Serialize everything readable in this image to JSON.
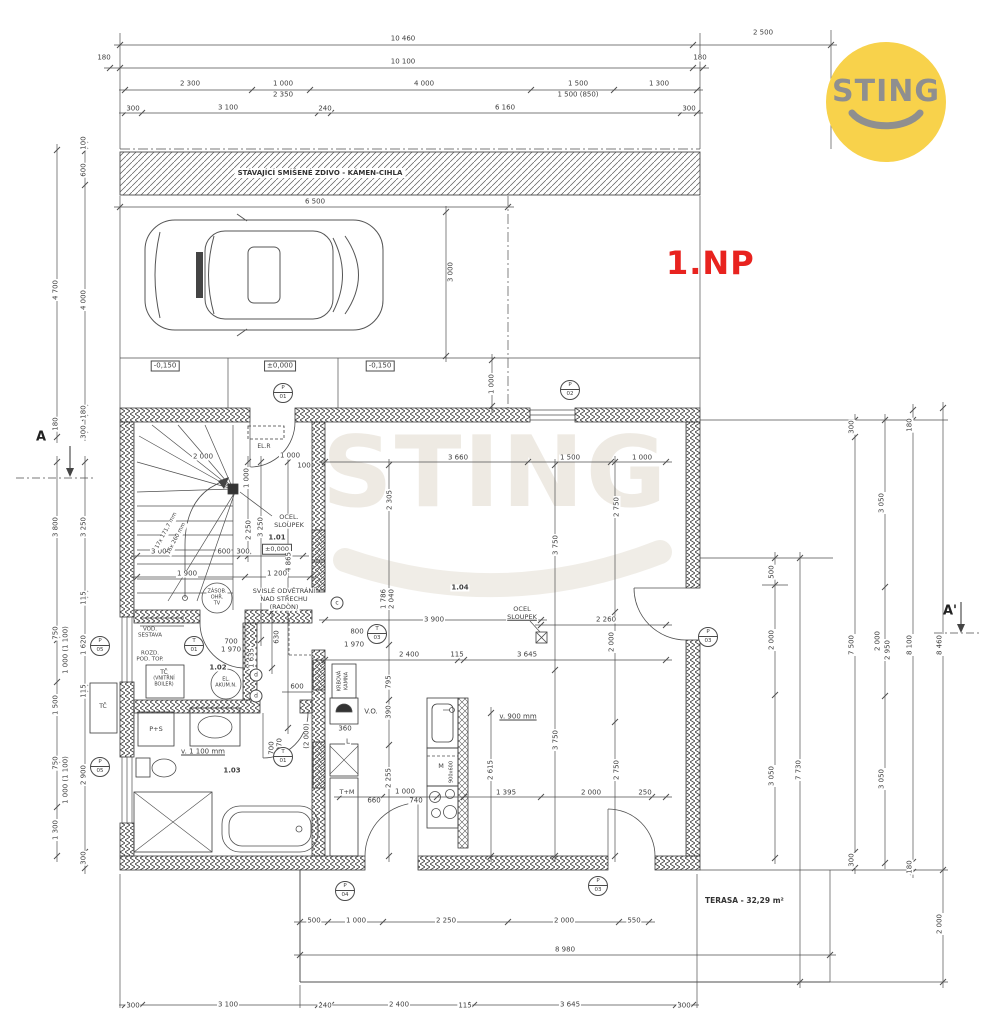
{
  "floor_label": "1.NP",
  "logo": {
    "text": "STING",
    "bg": "#F8D24B",
    "fg": "#8F8F8F"
  },
  "watermark": {
    "text": "STING"
  },
  "colors": {
    "line": "#4f4f4f",
    "wall": "#3f3f3f",
    "accent_red": "#e8231f",
    "logo_yellow": "#F8D24B"
  },
  "existing_wall": {
    "label": "STÁVAJÍCÍ SMÍŠENÉ ZDIVO - KÁMEN-CIHLA"
  },
  "terrace": {
    "label": "TERASA - 32,29 m²"
  },
  "sections": {
    "left": "A",
    "right": "A'"
  },
  "levels": [
    "-0,150",
    "±0,000",
    "-0,150"
  ],
  "stairs_note": [
    "17x 171,7 mm",
    "16x 260 mm"
  ],
  "annotations": [
    {
      "t": "10 460",
      "x": 403,
      "y": 39
    },
    {
      "t": "2 500",
      "x": 763,
      "y": 33
    },
    {
      "t": "180",
      "x": 104,
      "y": 58
    },
    {
      "t": "10 100",
      "x": 403,
      "y": 62
    },
    {
      "t": "180",
      "x": 700,
      "y": 58
    },
    {
      "t": "2 300",
      "x": 190,
      "y": 84
    },
    {
      "t": "1 000",
      "x": 283,
      "y": 84
    },
    {
      "t": "2 350",
      "x": 283,
      "y": 95
    },
    {
      "t": "4 000",
      "x": 424,
      "y": 84
    },
    {
      "t": "1 500",
      "x": 578,
      "y": 84
    },
    {
      "t": "1 500 (850)",
      "x": 578,
      "y": 95
    },
    {
      "t": "1 300",
      "x": 659,
      "y": 84
    },
    {
      "t": "300",
      "x": 133,
      "y": 109
    },
    {
      "t": "3 100",
      "x": 228,
      "y": 108
    },
    {
      "t": "240",
      "x": 325,
      "y": 109
    },
    {
      "t": "6 160",
      "x": 505,
      "y": 108
    },
    {
      "t": "300",
      "x": 689,
      "y": 109
    },
    {
      "t": "6 500",
      "x": 315,
      "y": 202
    },
    {
      "t": "3 000",
      "x": 451,
      "y": 272,
      "r": -90
    },
    {
      "t": "1 000",
      "x": 492,
      "y": 384,
      "r": -90
    },
    {
      "t": "4 700",
      "x": 56,
      "y": 290,
      "r": -90
    },
    {
      "t": "100",
      "x": 84,
      "y": 143,
      "r": -90
    },
    {
      "t": "600",
      "x": 84,
      "y": 170,
      "r": -90
    },
    {
      "t": "4 000",
      "x": 84,
      "y": 300,
      "r": -90
    },
    {
      "t": "180",
      "x": 56,
      "y": 424,
      "r": -90
    },
    {
      "t": "180",
      "x": 84,
      "y": 412,
      "r": -90
    },
    {
      "t": "300",
      "x": 84,
      "y": 432,
      "r": -90
    },
    {
      "t": "3 800",
      "x": 56,
      "y": 527,
      "r": -90
    },
    {
      "t": "3 250",
      "x": 84,
      "y": 527,
      "r": -90
    },
    {
      "t": "115",
      "x": 84,
      "y": 598,
      "r": -90
    },
    {
      "t": "750",
      "x": 56,
      "y": 633,
      "r": -90
    },
    {
      "t": "1 000 (1 100)",
      "x": 66,
      "y": 650,
      "r": -90
    },
    {
      "t": "1 620",
      "x": 84,
      "y": 645,
      "r": -90
    },
    {
      "t": "1 500",
      "x": 56,
      "y": 705,
      "r": -90
    },
    {
      "t": "115",
      "x": 84,
      "y": 691,
      "r": -90
    },
    {
      "t": "750",
      "x": 56,
      "y": 763,
      "r": -90
    },
    {
      "t": "1 000 (1 100)",
      "x": 66,
      "y": 780,
      "r": -90
    },
    {
      "t": "2 900",
      "x": 84,
      "y": 775,
      "r": -90
    },
    {
      "t": "1 300",
      "x": 56,
      "y": 830,
      "r": -90
    },
    {
      "t": "300",
      "x": 84,
      "y": 858,
      "r": -90
    },
    {
      "t": "2 000",
      "x": 203,
      "y": 457
    },
    {
      "t": "1 000",
      "x": 290,
      "y": 456
    },
    {
      "t": "100",
      "x": 304,
      "y": 466
    },
    {
      "t": "1 000",
      "x": 247,
      "y": 478,
      "r": -90
    },
    {
      "t": "EL.R",
      "x": 264,
      "y": 447,
      "s": 6
    },
    {
      "t": "OCEL.",
      "x": 289,
      "y": 517,
      "s": 6.5
    },
    {
      "t": "SLOUPEK",
      "x": 289,
      "y": 525,
      "s": 6.5
    },
    {
      "t": "1.01",
      "x": 277,
      "y": 538,
      "b": 1
    },
    {
      "t": "±0,000",
      "x": 277,
      "y": 549,
      "box": 1,
      "s": 6.5
    },
    {
      "t": "3 250",
      "x": 261,
      "y": 527,
      "r": -90
    },
    {
      "t": "2 250",
      "x": 249,
      "y": 530,
      "r": -90
    },
    {
      "t": "4 865",
      "x": 289,
      "y": 562,
      "r": -90
    },
    {
      "t": "3 000",
      "x": 161,
      "y": 552
    },
    {
      "t": "600",
      "x": 224,
      "y": 552
    },
    {
      "t": "300",
      "x": 243,
      "y": 552
    },
    {
      "t": "1 900",
      "x": 187,
      "y": 574
    },
    {
      "t": "1 200",
      "x": 277,
      "y": 574
    },
    {
      "t": "ZÁSOB.",
      "x": 217,
      "y": 592,
      "s": 5
    },
    {
      "t": "OHŘ.",
      "x": 217,
      "y": 598,
      "s": 5
    },
    {
      "t": "TV",
      "x": 217,
      "y": 604,
      "s": 5
    },
    {
      "t": "SVISLÉ ODVĚTRÁNÍ",
      "x": 284,
      "y": 591,
      "s": 6.5
    },
    {
      "t": "NAD STŘECHU",
      "x": 284,
      "y": 599,
      "s": 6.5
    },
    {
      "t": "(RADON)",
      "x": 284,
      "y": 607,
      "s": 6.5
    },
    {
      "t": "630",
      "x": 277,
      "y": 637,
      "r": -90
    },
    {
      "t": "1 635",
      "x": 252,
      "y": 658,
      "r": -90
    },
    {
      "t": "600",
      "x": 297,
      "y": 687
    },
    {
      "t": "VOD.",
      "x": 150,
      "y": 630,
      "s": 5.5
    },
    {
      "t": "SESTAVA",
      "x": 150,
      "y": 636,
      "s": 5.5
    },
    {
      "t": "ROZD.",
      "x": 150,
      "y": 654,
      "s": 5.5
    },
    {
      "t": "POD. TOP.",
      "x": 150,
      "y": 660,
      "s": 5.5
    },
    {
      "t": "700",
      "x": 231,
      "y": 642
    },
    {
      "t": "1 970",
      "x": 231,
      "y": 650
    },
    {
      "t": "1.02",
      "x": 218,
      "y": 668,
      "b": 1
    },
    {
      "t": "TČ",
      "x": 164,
      "y": 673,
      "s": 6
    },
    {
      "t": "(VNITŘNÍ",
      "x": 164,
      "y": 680,
      "s": 4.8
    },
    {
      "t": "BOILER)",
      "x": 164,
      "y": 686,
      "s": 4.8
    },
    {
      "t": "EL.",
      "x": 226,
      "y": 680,
      "s": 5
    },
    {
      "t": "AKUM.N.",
      "x": 226,
      "y": 686,
      "s": 5
    },
    {
      "t": "TČ",
      "x": 103,
      "y": 707,
      "s": 6
    },
    {
      "t": "P+S",
      "x": 156,
      "y": 729,
      "s": 6.5
    },
    {
      "t": "v. 1 100 mm",
      "x": 203,
      "y": 752,
      "u": 1
    },
    {
      "t": "1.03",
      "x": 232,
      "y": 771,
      "b": 1
    },
    {
      "t": "700",
      "x": 272,
      "y": 748,
      "r": -90
    },
    {
      "t": "1 970",
      "x": 280,
      "y": 748,
      "r": -90
    },
    {
      "t": "(2 000)",
      "x": 307,
      "y": 736,
      "r": -90
    },
    {
      "t": "KRBOVÁ",
      "x": 340,
      "y": 681,
      "r": -90,
      "s": 5
    },
    {
      "t": "KAMNA",
      "x": 347,
      "y": 681,
      "r": -90,
      "s": 5
    },
    {
      "t": "V.O.",
      "x": 371,
      "y": 712,
      "s": 7
    },
    {
      "t": "360",
      "x": 345,
      "y": 729
    },
    {
      "t": "L",
      "x": 348,
      "y": 742
    },
    {
      "t": "T+M",
      "x": 347,
      "y": 792,
      "s": 6.5
    },
    {
      "t": "795",
      "x": 389,
      "y": 682,
      "r": -90
    },
    {
      "t": "390",
      "x": 389,
      "y": 712,
      "r": -90
    },
    {
      "t": "2 255",
      "x": 389,
      "y": 778,
      "r": -90
    },
    {
      "t": "660",
      "x": 374,
      "y": 801
    },
    {
      "t": "1 000",
      "x": 405,
      "y": 792
    },
    {
      "t": "740",
      "x": 416,
      "y": 801
    },
    {
      "t": "M",
      "x": 441,
      "y": 766,
      "s": 6.5
    },
    {
      "t": "900x600",
      "x": 452,
      "y": 772,
      "r": -90,
      "s": 5
    },
    {
      "t": "2 615",
      "x": 491,
      "y": 770,
      "r": -90
    },
    {
      "t": "v. 900 mm",
      "x": 518,
      "y": 717,
      "u": 1
    },
    {
      "t": "3 660",
      "x": 458,
      "y": 458
    },
    {
      "t": "1 500",
      "x": 570,
      "y": 458
    },
    {
      "t": "1 000",
      "x": 642,
      "y": 458
    },
    {
      "t": "2 305",
      "x": 390,
      "y": 500,
      "r": -90
    },
    {
      "t": "3 750",
      "x": 556,
      "y": 545,
      "r": -90
    },
    {
      "t": "2 750",
      "x": 617,
      "y": 507,
      "r": -90
    },
    {
      "t": "1.04",
      "x": 460,
      "y": 588,
      "b": 1
    },
    {
      "t": "OCEL",
      "x": 522,
      "y": 609,
      "s": 6.5
    },
    {
      "t": "SLOUPEK",
      "x": 522,
      "y": 617,
      "s": 6.5,
      "u": 1
    },
    {
      "t": "1 786",
      "x": 384,
      "y": 599,
      "r": -90
    },
    {
      "t": "2 040",
      "x": 392,
      "y": 599,
      "r": -90
    },
    {
      "t": "800",
      "x": 357,
      "y": 632
    },
    {
      "t": "1 970",
      "x": 354,
      "y": 645
    },
    {
      "t": "3 900",
      "x": 434,
      "y": 620
    },
    {
      "t": "2 260",
      "x": 606,
      "y": 620
    },
    {
      "t": "2 000",
      "x": 612,
      "y": 642,
      "r": -90
    },
    {
      "t": "2 400",
      "x": 409,
      "y": 655
    },
    {
      "t": "115",
      "x": 457,
      "y": 655
    },
    {
      "t": "3 645",
      "x": 527,
      "y": 655
    },
    {
      "t": "3 750",
      "x": 556,
      "y": 740,
      "r": -90
    },
    {
      "t": "2 750",
      "x": 617,
      "y": 770,
      "r": -90
    },
    {
      "t": "1 395",
      "x": 506,
      "y": 793
    },
    {
      "t": "2 000",
      "x": 591,
      "y": 793
    },
    {
      "t": "250",
      "x": 645,
      "y": 793
    },
    {
      "t": "500",
      "x": 314,
      "y": 921
    },
    {
      "t": "1 000",
      "x": 356,
      "y": 921
    },
    {
      "t": "2 250",
      "x": 446,
      "y": 921
    },
    {
      "t": "2 000",
      "x": 564,
      "y": 921
    },
    {
      "t": "550",
      "x": 634,
      "y": 921
    },
    {
      "t": "8 980",
      "x": 565,
      "y": 950
    },
    {
      "t": "300",
      "x": 133,
      "y": 1006
    },
    {
      "t": "3 100",
      "x": 228,
      "y": 1005
    },
    {
      "t": "240",
      "x": 325,
      "y": 1006
    },
    {
      "t": "2 400",
      "x": 399,
      "y": 1005
    },
    {
      "t": "115",
      "x": 465,
      "y": 1006
    },
    {
      "t": "3 645",
      "x": 570,
      "y": 1005
    },
    {
      "t": "300",
      "x": 684,
      "y": 1006
    },
    {
      "t": "500",
      "x": 772,
      "y": 572,
      "r": -90
    },
    {
      "t": "2 000",
      "x": 772,
      "y": 640,
      "r": -90
    },
    {
      "t": "3 050",
      "x": 772,
      "y": 776,
      "r": -90
    },
    {
      "t": "7 730",
      "x": 799,
      "y": 770,
      "r": -90
    },
    {
      "t": "300",
      "x": 852,
      "y": 427,
      "r": -90
    },
    {
      "t": "7 500",
      "x": 852,
      "y": 645,
      "r": -90
    },
    {
      "t": "300",
      "x": 852,
      "y": 860,
      "r": -90
    },
    {
      "t": "3 050",
      "x": 882,
      "y": 503,
      "r": -90
    },
    {
      "t": "2 000",
      "x": 878,
      "y": 641,
      "r": -90
    },
    {
      "t": "2 950",
      "x": 888,
      "y": 650,
      "r": -90
    },
    {
      "t": "3 050",
      "x": 882,
      "y": 779,
      "r": -90
    },
    {
      "t": "180",
      "x": 910,
      "y": 425,
      "r": -90
    },
    {
      "t": "8 100",
      "x": 910,
      "y": 645,
      "r": -90
    },
    {
      "t": "180",
      "x": 910,
      "y": 867,
      "r": -90
    },
    {
      "t": "8 460",
      "x": 940,
      "y": 645,
      "r": -90
    },
    {
      "t": "2 000",
      "x": 940,
      "y": 924,
      "r": -90
    }
  ],
  "position_markers": [
    {
      "a": "P",
      "b": "01",
      "x": 283,
      "y": 393
    },
    {
      "a": "P",
      "b": "02",
      "x": 570,
      "y": 390
    },
    {
      "a": "P",
      "b": "03",
      "x": 708,
      "y": 637
    },
    {
      "a": "P",
      "b": "05",
      "x": 100,
      "y": 646
    },
    {
      "a": "P",
      "b": "05",
      "x": 100,
      "y": 767
    },
    {
      "a": "P",
      "b": "04",
      "x": 345,
      "y": 891
    },
    {
      "a": "P",
      "b": "03",
      "x": 598,
      "y": 886
    },
    {
      "a": "T",
      "b": "01",
      "x": 194,
      "y": 646
    },
    {
      "a": "T",
      "b": "01",
      "x": 283,
      "y": 757
    },
    {
      "a": "T",
      "b": "03",
      "x": 377,
      "y": 634
    }
  ],
  "vent_markers": [
    {
      "t": "c",
      "x": 337,
      "y": 603
    },
    {
      "t": "d",
      "x": 256,
      "y": 675
    },
    {
      "t": "d",
      "x": 256,
      "y": 696
    }
  ]
}
